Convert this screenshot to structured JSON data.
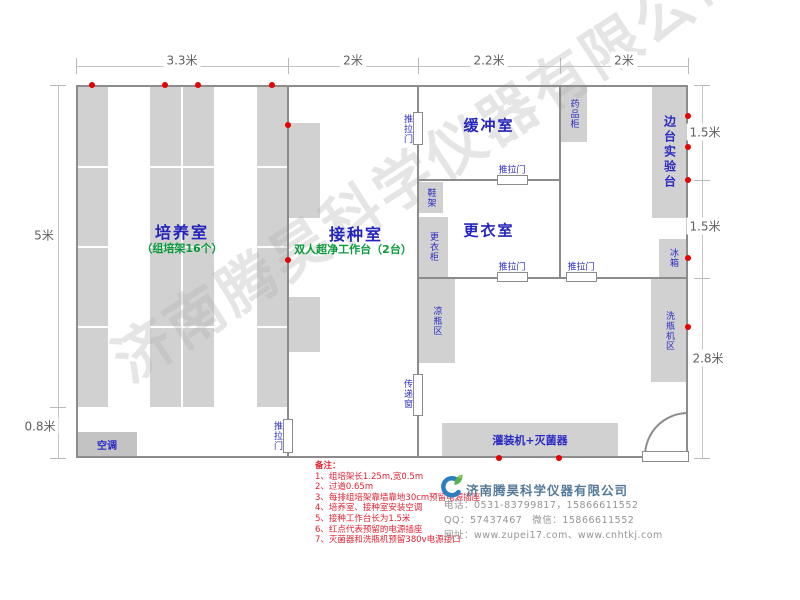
{
  "watermark": "济南腾昊科学仪器有限公司",
  "dimensions": {
    "top": [
      "3.3米",
      "2米",
      "2.2米",
      "2米"
    ],
    "left": [
      "5米",
      "0.8米"
    ],
    "right": [
      "1.5米",
      "1.5米",
      "2.8米"
    ]
  },
  "rooms": {
    "culture": {
      "name": "培养室",
      "sub": "（组培架16个）"
    },
    "inoculation": {
      "name": "接种室",
      "sub": "双人超净工作台（2台）"
    },
    "buffer": {
      "name": "缓冲室"
    },
    "changing": {
      "name": "更衣室"
    }
  },
  "fixtures": {
    "sliding_door": "推拉门",
    "transfer_window": "传递窗",
    "air_conditioner": "空调",
    "medicine_cabinet": "药品柜",
    "side_bench": "边台实验台",
    "fridge": "冰箱",
    "bottle_washer_area": "洗瓶机区",
    "bottle_cooling_area": "凉瓶区",
    "shoe_rack": "鞋架",
    "locker": "更衣柜",
    "filling_machine": "灌装机+灭菌器"
  },
  "notes": {
    "title": "备注：",
    "items": [
      "1、组培架长1.25m,宽0.5m",
      "2、过道0.65m",
      "3、每排组培架靠墙靠地30cm预留电源插座",
      "4、培养室、接种室安装空调",
      "5、接种工作台长为1.5米",
      "6、红点代表预留的电源插座",
      "7、灭菌器和洗瓶机预留380v电源接口"
    ]
  },
  "company": {
    "name": "济南腾昊科学仪器有限公司",
    "phone": "电话：0531-83799817，15866611552",
    "qq_wechat": "QQ：57437467　微信：15866611552",
    "website": "网址：www.zupei17.com、www.cnhtkj.com"
  },
  "colors": {
    "room_label": "#2424bd",
    "sub_label": "#0a9a3c",
    "notes_red": "#e22233",
    "outlet_dot": "#e60000",
    "wall_gray": "#8c8c8c",
    "block_gray": "#d1d1d1",
    "company_blue": "#567a9a"
  }
}
